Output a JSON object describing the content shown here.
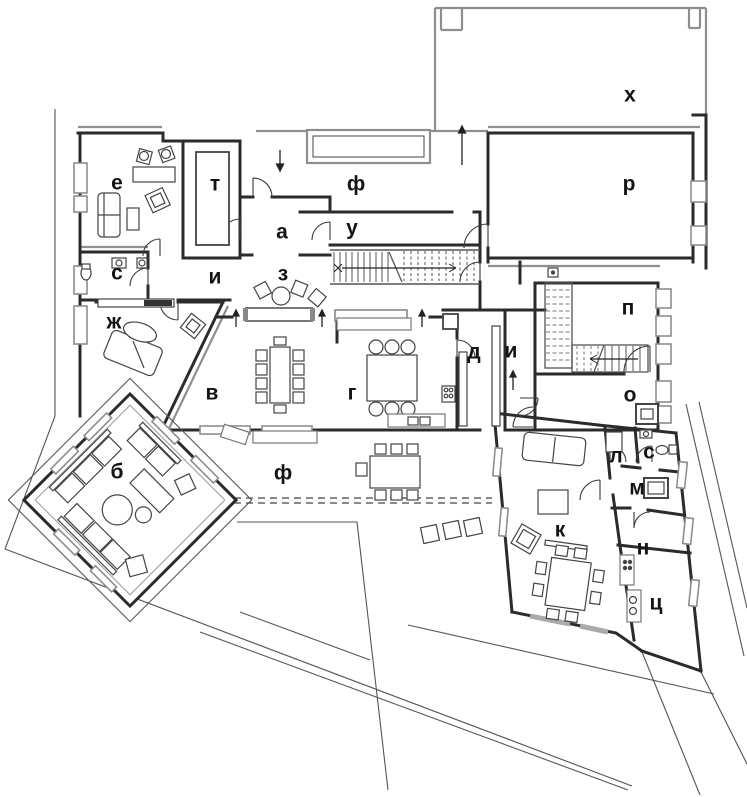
{
  "title": "floor-plan",
  "colors": {
    "wall": "#2b2b2b",
    "thin_line": "#555555",
    "gray_structure": "#8e8e8e",
    "label": "#141414",
    "background": "#ffffff"
  },
  "rooms": [
    {
      "id": "room-e",
      "label": "е"
    },
    {
      "id": "room-t",
      "label": "т"
    },
    {
      "id": "room-f-terrace-top",
      "label": "ф"
    },
    {
      "id": "room-a",
      "label": "а"
    },
    {
      "id": "room-u",
      "label": "у"
    },
    {
      "id": "room-h",
      "label": "х"
    },
    {
      "id": "room-r",
      "label": "р"
    },
    {
      "id": "room-s-wc",
      "label": "с"
    },
    {
      "id": "room-i-corridor",
      "label": "и"
    },
    {
      "id": "room-z",
      "label": "з"
    },
    {
      "id": "room-p",
      "label": "п"
    },
    {
      "id": "room-zh",
      "label": "ж"
    },
    {
      "id": "room-v",
      "label": "в"
    },
    {
      "id": "room-g",
      "label": "г"
    },
    {
      "id": "room-d",
      "label": "д"
    },
    {
      "id": "room-i2-corridor",
      "label": "и"
    },
    {
      "id": "room-o",
      "label": "о"
    },
    {
      "id": "room-b",
      "label": "б"
    },
    {
      "id": "room-f-terrace-bottom",
      "label": "ф"
    },
    {
      "id": "room-k",
      "label": "к"
    },
    {
      "id": "room-l",
      "label": "л"
    },
    {
      "id": "room-s2-bath",
      "label": "с"
    },
    {
      "id": "room-m",
      "label": "м"
    },
    {
      "id": "room-n",
      "label": "н"
    },
    {
      "id": "room-ts",
      "label": "ц"
    }
  ]
}
